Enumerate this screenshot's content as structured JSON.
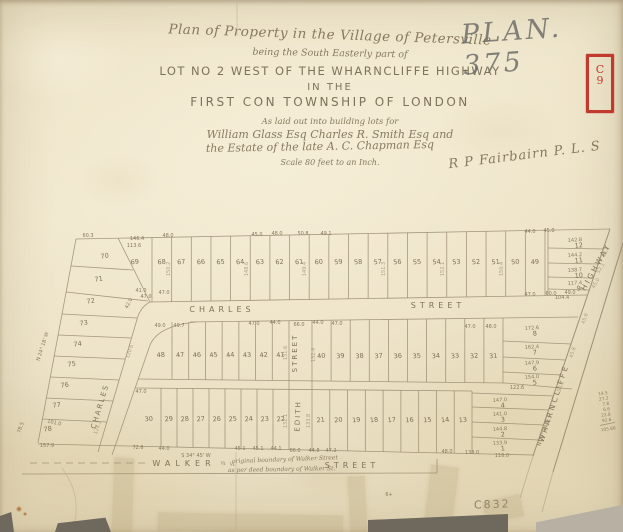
{
  "plan_number": "PLAN. 375",
  "stamp": {
    "letter": "C",
    "digit": "9"
  },
  "archive_code": "C832",
  "surveyor_signature": "R P Fairbairn P. L. S",
  "title_block": {
    "line1": "Plan of Property in the Village of Petersville",
    "line2": "being the South Easterly part of",
    "line3": "LOT NO 2 WEST OF THE WHARNCLIFFE HIGHWAY",
    "line4": "IN THE",
    "line5": "FIRST CON  TOWNSHIP  OF  LONDON",
    "line6": "As laid out into building lots for",
    "line7": "William Glass Esq   Charles R. Smith Esq and",
    "line8": "the Estate of the late A. C. Chapman Esq",
    "line9": "Scale 80 feet to an Inch."
  },
  "streets": {
    "charles_west": "CHARLES",
    "charles_east": "STREET",
    "edith_upper": "STREET",
    "edith_lower": "EDITH",
    "walker_west": "WALKER",
    "walker_east": "STREET",
    "charles_diag": "CHARLES",
    "wharncliffe": "WHARNCLIFFE",
    "highway": "HIGHWAY"
  },
  "map": {
    "top_row_lots": [
      "69",
      "68",
      "67",
      "66",
      "65",
      "64",
      "63",
      "62",
      "61",
      "60",
      "59",
      "58",
      "57",
      "56",
      "55",
      "54",
      "53",
      "52",
      "51",
      "50",
      "49"
    ],
    "mid_row_west_lots": [
      "48",
      "47",
      "46",
      "45",
      "44",
      "43",
      "42",
      "41"
    ],
    "mid_row_east_lots": [
      "40",
      "39",
      "38",
      "37",
      "36",
      "35",
      "34",
      "33",
      "32",
      "31"
    ],
    "bottom_row_west_lots": [
      "30",
      "29",
      "28",
      "27",
      "26",
      "25",
      "24",
      "23",
      "22"
    ],
    "bottom_row_east_lots": [
      "21",
      "20",
      "19",
      "18",
      "17",
      "16",
      "15",
      "14",
      "13"
    ],
    "west_strip_lots": [
      "70",
      "71",
      "72",
      "73",
      "74",
      "75",
      "76",
      "77",
      "78"
    ],
    "ne_block": [
      {
        "n": "12",
        "m": "142.8"
      },
      {
        "n": "11",
        "m": "144.2"
      },
      {
        "n": "10",
        "m": "138.7"
      },
      {
        "n": "9",
        "m": "117.4"
      }
    ],
    "east_mid_block": [
      {
        "n": "8",
        "m": "172.6"
      },
      {
        "n": "7",
        "m": "162.4"
      },
      {
        "n": "6",
        "m": "147.9"
      },
      {
        "n": "5",
        "m": "154.0"
      }
    ],
    "east_bottom_block": [
      {
        "n": "4",
        "m": "147.0"
      },
      {
        "n": "3",
        "m": "141.0"
      },
      {
        "n": "2",
        "m": "144.8"
      },
      {
        "n": "1",
        "m": "133.9"
      }
    ],
    "measurements": [
      {
        "t": "60.3",
        "x": 88,
        "y": 237
      },
      {
        "t": "146.4",
        "x": 137,
        "y": 240,
        "s": 4.3
      },
      {
        "t": "113.6",
        "x": 134,
        "y": 247
      },
      {
        "t": "48.0",
        "x": 168,
        "y": 237
      },
      {
        "t": "45.0",
        "x": 257,
        "y": 236
      },
      {
        "t": "48.0",
        "x": 277,
        "y": 235
      },
      {
        "t": "50.8",
        "x": 303,
        "y": 235
      },
      {
        "t": "49.1",
        "x": 326,
        "y": 235
      },
      {
        "t": "44.0",
        "x": 530,
        "y": 233
      },
      {
        "t": "45.0",
        "x": 549,
        "y": 232
      },
      {
        "t": "41.0",
        "x": 141,
        "y": 292
      },
      {
        "t": "47.0",
        "x": 164,
        "y": 294
      },
      {
        "t": "47.0",
        "x": 530,
        "y": 296
      },
      {
        "t": "60.0",
        "x": 551,
        "y": 295
      },
      {
        "t": "49.0",
        "x": 570,
        "y": 294
      },
      {
        "t": "49.0",
        "x": 160,
        "y": 327
      },
      {
        "t": "49.7",
        "x": 179,
        "y": 327
      },
      {
        "t": "47.0",
        "x": 254,
        "y": 325
      },
      {
        "t": "44.0",
        "x": 275,
        "y": 324
      },
      {
        "t": "66.0",
        "x": 299,
        "y": 326
      },
      {
        "t": "44.0",
        "x": 318,
        "y": 324
      },
      {
        "t": "47.0",
        "x": 337,
        "y": 325
      },
      {
        "t": "47.0",
        "x": 470,
        "y": 328
      },
      {
        "t": "48.0",
        "x": 491,
        "y": 328
      },
      {
        "t": "122.6",
        "x": 517,
        "y": 389
      },
      {
        "t": "47.0",
        "x": 141,
        "y": 393
      },
      {
        "t": "72.6",
        "x": 138,
        "y": 449
      },
      {
        "t": "44.0",
        "x": 164,
        "y": 450
      },
      {
        "t": "45.1",
        "x": 240,
        "y": 450
      },
      {
        "t": "45.1",
        "x": 258,
        "y": 450
      },
      {
        "t": "44.1",
        "x": 276,
        "y": 450
      },
      {
        "t": "66.0",
        "x": 295,
        "y": 452
      },
      {
        "t": "44.8",
        "x": 314,
        "y": 452
      },
      {
        "t": "47.2",
        "x": 331,
        "y": 452
      },
      {
        "t": "48.0",
        "x": 447,
        "y": 453
      },
      {
        "t": "138.0",
        "x": 472,
        "y": 454
      },
      {
        "t": "116.0",
        "x": 502,
        "y": 457
      },
      {
        "t": "104.4",
        "x": 562,
        "y": 299,
        "s": 4.5
      },
      {
        "t": "78.5",
        "x": 22,
        "y": 428,
        "r": -70
      },
      {
        "t": "101.0",
        "x": 54,
        "y": 424,
        "r": 12
      },
      {
        "t": "157.9",
        "x": 47,
        "y": 447
      },
      {
        "t": "47.0",
        "x": 146,
        "y": 298,
        "s": 4.3
      },
      {
        "t": "42.0",
        "x": 130,
        "y": 304,
        "r": -65,
        "s": 4.3
      },
      {
        "t": "120.6",
        "x": 131,
        "y": 352,
        "r": -72,
        "s": 4.2,
        "c": "d"
      },
      {
        "t": "124.2",
        "x": 99,
        "y": 428,
        "r": -72,
        "s": 4.2,
        "c": "d"
      },
      {
        "t": "S 34° 45' W",
        "x": 196,
        "y": 457,
        "s": 5
      },
      {
        "t": "N 24° 18' W",
        "x": 44,
        "y": 347,
        "r": -72,
        "s": 4.6
      },
      {
        "t": "N 29° 14' E",
        "x": 545,
        "y": 433,
        "r": -71,
        "s": 4.4
      },
      {
        "t": "150.2",
        "x": 170,
        "y": 269,
        "r": -90,
        "s": 4.2,
        "c": "d"
      },
      {
        "t": "148.6",
        "x": 248,
        "y": 269,
        "r": -90,
        "s": 4.2,
        "c": "d"
      },
      {
        "t": "149.4",
        "x": 306,
        "y": 269,
        "r": -90,
        "s": 4.2,
        "c": "d"
      },
      {
        "t": "151.3",
        "x": 385,
        "y": 269,
        "r": -90,
        "s": 4.2,
        "c": "d"
      },
      {
        "t": "152.1",
        "x": 444,
        "y": 269,
        "r": -90,
        "s": 4.2,
        "c": "d"
      },
      {
        "t": "150.4",
        "x": 503,
        "y": 269,
        "r": -90,
        "s": 4.2,
        "c": "d"
      },
      {
        "t": "131.6",
        "x": 287,
        "y": 353,
        "r": -90,
        "s": 4.2,
        "c": "d"
      },
      {
        "t": "132.4",
        "x": 315,
        "y": 355,
        "r": -90,
        "s": 4.2,
        "c": "d"
      },
      {
        "t": "132.1",
        "x": 287,
        "y": 421,
        "r": -90,
        "s": 4.2,
        "c": "d"
      },
      {
        "t": "133.8",
        "x": 310,
        "y": 421,
        "r": -90,
        "s": 4.2,
        "c": "d"
      },
      {
        "t": "45.6",
        "x": 586,
        "y": 319,
        "r": -71,
        "s": 4,
        "c": "d"
      },
      {
        "t": "45.8",
        "x": 574,
        "y": 353,
        "r": -71,
        "s": 4,
        "c": "d"
      },
      {
        "t": "50.1",
        "x": 562,
        "y": 387,
        "r": -71,
        "s": 4,
        "c": "d"
      },
      {
        "t": "45.5",
        "x": 550,
        "y": 421,
        "r": -71,
        "s": 4,
        "c": "d"
      },
      {
        "t": "48.4",
        "x": 607,
        "y": 253,
        "r": -60,
        "s": 4,
        "c": "d"
      },
      {
        "t": "52.1",
        "x": 602,
        "y": 269,
        "r": -60,
        "s": 4,
        "c": "d"
      },
      {
        "t": "45.0",
        "x": 597,
        "y": 284,
        "r": -60,
        "s": 4,
        "c": "d"
      },
      {
        "t": "⅔",
        "x": 223,
        "y": 465,
        "s": 6
      },
      {
        "t": "⅓",
        "x": 232,
        "y": 466,
        "s": 6
      },
      {
        "t": "6+",
        "x": 389,
        "y": 496,
        "s": 5
      }
    ],
    "notes": [
      {
        "t": "original boundary of Walker Street",
        "x": 232,
        "y": 463,
        "r": -2
      },
      {
        "t": "as per deed boundary of Walker St.",
        "x": 228,
        "y": 472,
        "r": -1
      }
    ],
    "sum_column": {
      "values": [
        "14.5",
        "27.2",
        "7.8",
        "6.6",
        "22.8",
        "92.6"
      ],
      "total": "105.66"
    }
  }
}
